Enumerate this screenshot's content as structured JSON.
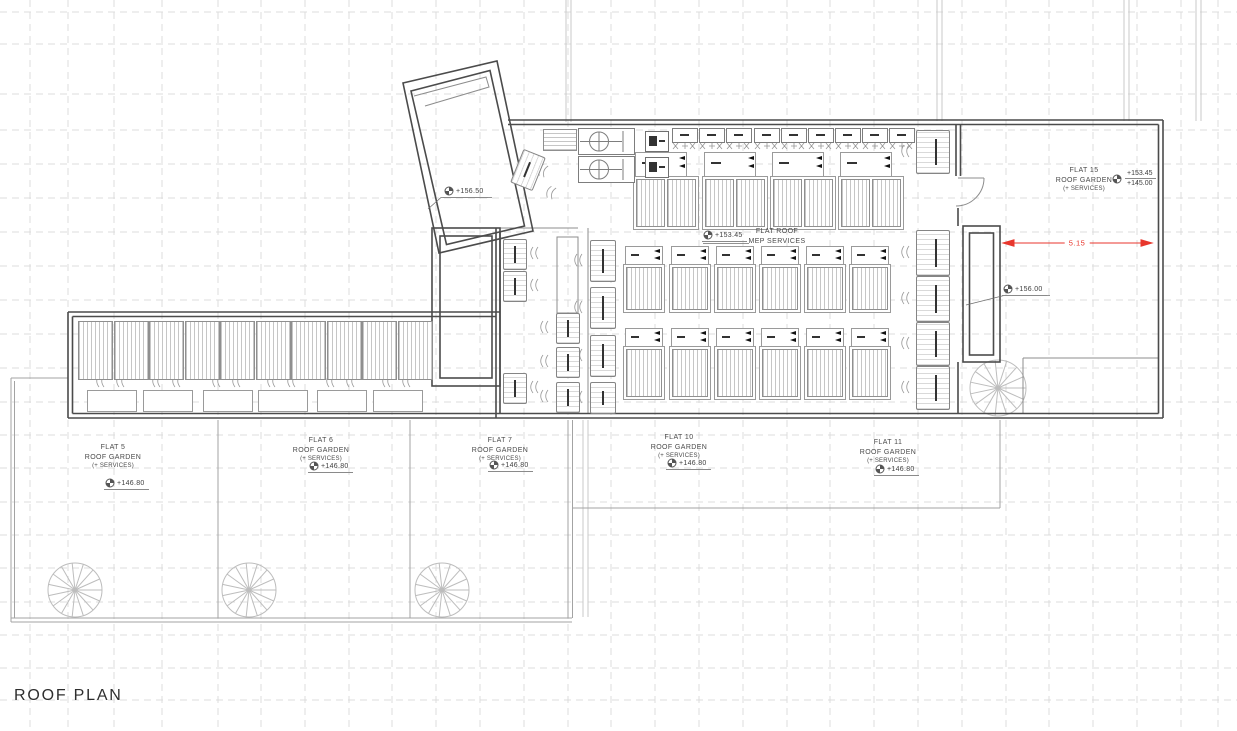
{
  "title": "ROOF PLAN",
  "colors": {
    "dimension_red": "#e8362c",
    "wall": "#4b4b4b",
    "text": "#4a4a4a"
  },
  "dimension": {
    "value": "5.15"
  },
  "markers": {
    "tower_level": "+156.50",
    "shaft_level": "+156.00"
  },
  "mep_area": {
    "level": "+153.45",
    "name_line1": "FLAT ROOF",
    "name_line2": "MEP SERVICES"
  },
  "flat15": {
    "name_line1": "FLAT 15",
    "name_line2": "ROOF GARDEN",
    "name_line3": "(+ SERVICES)",
    "level_upper": "+153.45",
    "level_lower": "+145.00"
  },
  "flats": [
    {
      "name_line1": "FLAT 5",
      "name_line2": "ROOF GARDEN",
      "name_line3": "(+ SERVICES)",
      "level": "+146.80"
    },
    {
      "name_line1": "FLAT 6",
      "name_line2": "ROOF GARDEN",
      "name_line3": "(+ SERVICES)",
      "level": "+146.80"
    },
    {
      "name_line1": "FLAT 7",
      "name_line2": "ROOF GARDEN",
      "name_line3": "(+ SERVICES)",
      "level": "+146.80"
    },
    {
      "name_line1": "FLAT 10",
      "name_line2": "ROOF GARDEN",
      "name_line3": "(+ SERVICES)",
      "level": "+146.80"
    },
    {
      "name_line1": "FLAT 11",
      "name_line2": "ROOF GARDEN",
      "name_line3": "(+ SERVICES)",
      "level": "+146.80"
    }
  ]
}
